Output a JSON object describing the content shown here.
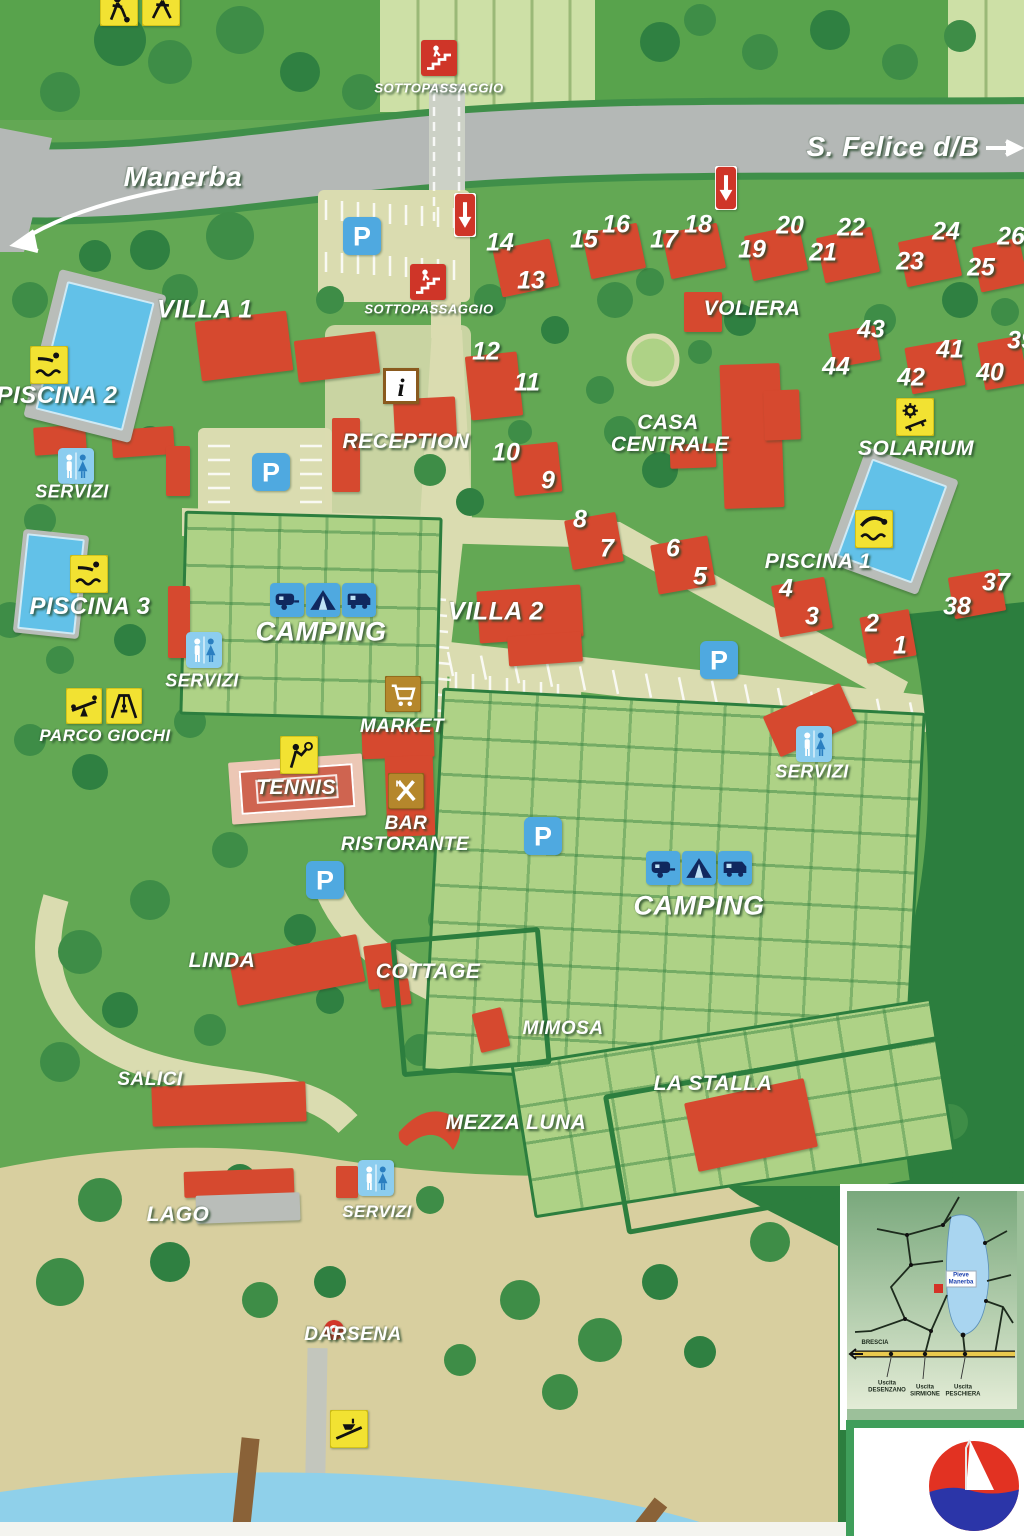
{
  "map": {
    "road_labels": [
      {
        "text": "Manerba",
        "x": 183,
        "y": 177,
        "size": 28
      },
      {
        "text": "S. Felice d/B",
        "x": 893,
        "y": 147,
        "size": 28
      }
    ],
    "place_labels": [
      {
        "text": "SOTTOPASSAGGIO",
        "x": 439,
        "y": 88,
        "size": 13
      },
      {
        "text": "SOTTOPASSAGGIO",
        "x": 429,
        "y": 309,
        "size": 13
      },
      {
        "text": "VILLA 1",
        "x": 205,
        "y": 310,
        "size": 25
      },
      {
        "text": "PISCINA 2",
        "x": 57,
        "y": 396,
        "size": 24
      },
      {
        "text": "SERVIZI",
        "x": 72,
        "y": 492,
        "size": 18
      },
      {
        "text": "PISCINA 3",
        "x": 90,
        "y": 607,
        "size": 24
      },
      {
        "text": "RECEPTION",
        "x": 406,
        "y": 442,
        "size": 21
      },
      {
        "text": "CASA",
        "x": 668,
        "y": 423,
        "size": 21
      },
      {
        "text": "CENTRALE",
        "x": 670,
        "y": 445,
        "size": 21
      },
      {
        "text": "VOLIERA",
        "x": 752,
        "y": 309,
        "size": 21
      },
      {
        "text": "SOLARIUM",
        "x": 916,
        "y": 449,
        "size": 21
      },
      {
        "text": "PISCINA 1",
        "x": 818,
        "y": 562,
        "size": 21
      },
      {
        "text": "CAMPING",
        "x": 321,
        "y": 632,
        "size": 27
      },
      {
        "text": "VILLA 2",
        "x": 496,
        "y": 612,
        "size": 25
      },
      {
        "text": "SERVIZI",
        "x": 202,
        "y": 681,
        "size": 18
      },
      {
        "text": "PARCO GIOCHI",
        "x": 105,
        "y": 736,
        "size": 17
      },
      {
        "text": "MARKET",
        "x": 402,
        "y": 727,
        "size": 19
      },
      {
        "text": "TENNIS",
        "x": 296,
        "y": 788,
        "size": 21
      },
      {
        "text": "BAR",
        "x": 406,
        "y": 824,
        "size": 19
      },
      {
        "text": "RISTORANTE",
        "x": 405,
        "y": 845,
        "size": 19
      },
      {
        "text": "SERVIZI",
        "x": 812,
        "y": 772,
        "size": 18
      },
      {
        "text": "CAMPING",
        "x": 699,
        "y": 906,
        "size": 27
      },
      {
        "text": "LINDA",
        "x": 222,
        "y": 961,
        "size": 21
      },
      {
        "text": "COTTAGE",
        "x": 428,
        "y": 972,
        "size": 21
      },
      {
        "text": "MIMOSA",
        "x": 563,
        "y": 1029,
        "size": 19
      },
      {
        "text": "SALICI",
        "x": 150,
        "y": 1080,
        "size": 19
      },
      {
        "text": "LA STALLA",
        "x": 713,
        "y": 1084,
        "size": 21
      },
      {
        "text": "MEZZA LUNA",
        "x": 516,
        "y": 1123,
        "size": 21
      },
      {
        "text": "LAGO",
        "x": 178,
        "y": 1215,
        "size": 21
      },
      {
        "text": "SERVIZI",
        "x": 377,
        "y": 1212,
        "size": 17
      },
      {
        "text": "DARSENA",
        "x": 353,
        "y": 1335,
        "size": 19
      }
    ],
    "numbers": [
      {
        "n": "1",
        "x": 900,
        "y": 646
      },
      {
        "n": "2",
        "x": 872,
        "y": 624
      },
      {
        "n": "3",
        "x": 812,
        "y": 617
      },
      {
        "n": "4",
        "x": 786,
        "y": 589
      },
      {
        "n": "5",
        "x": 700,
        "y": 577
      },
      {
        "n": "6",
        "x": 673,
        "y": 549
      },
      {
        "n": "7",
        "x": 607,
        "y": 549
      },
      {
        "n": "8",
        "x": 580,
        "y": 520
      },
      {
        "n": "9",
        "x": 548,
        "y": 481
      },
      {
        "n": "10",
        "x": 506,
        "y": 453
      },
      {
        "n": "11",
        "x": 527,
        "y": 383
      },
      {
        "n": "12",
        "x": 486,
        "y": 352
      },
      {
        "n": "13",
        "x": 531,
        "y": 281
      },
      {
        "n": "14",
        "x": 500,
        "y": 243
      },
      {
        "n": "15",
        "x": 584,
        "y": 240
      },
      {
        "n": "16",
        "x": 616,
        "y": 225
      },
      {
        "n": "17",
        "x": 664,
        "y": 240
      },
      {
        "n": "18",
        "x": 698,
        "y": 225
      },
      {
        "n": "19",
        "x": 752,
        "y": 250
      },
      {
        "n": "20",
        "x": 790,
        "y": 226
      },
      {
        "n": "21",
        "x": 823,
        "y": 253
      },
      {
        "n": "22",
        "x": 851,
        "y": 228
      },
      {
        "n": "23",
        "x": 910,
        "y": 262
      },
      {
        "n": "24",
        "x": 946,
        "y": 232
      },
      {
        "n": "25",
        "x": 981,
        "y": 268
      },
      {
        "n": "26",
        "x": 1011,
        "y": 237
      },
      {
        "n": "37",
        "x": 996,
        "y": 583
      },
      {
        "n": "38",
        "x": 957,
        "y": 607
      },
      {
        "n": "39",
        "x": 1021,
        "y": 341
      },
      {
        "n": "40",
        "x": 990,
        "y": 373
      },
      {
        "n": "41",
        "x": 950,
        "y": 350
      },
      {
        "n": "42",
        "x": 911,
        "y": 378
      },
      {
        "n": "43",
        "x": 871,
        "y": 330
      },
      {
        "n": "44",
        "x": 836,
        "y": 367
      }
    ],
    "icons": [
      {
        "type": "soccer",
        "x": 100,
        "y": -12,
        "w": 38,
        "h": 38
      },
      {
        "type": "runner",
        "x": 142,
        "y": -12,
        "w": 38,
        "h": 38
      },
      {
        "type": "underpass",
        "x": 421,
        "y": 40,
        "w": 36,
        "h": 36
      },
      {
        "type": "underpass",
        "x": 410,
        "y": 264,
        "w": 36,
        "h": 36
      },
      {
        "type": "oneway",
        "x": 454,
        "y": 193,
        "w": 22,
        "h": 44
      },
      {
        "type": "oneway",
        "x": 715,
        "y": 166,
        "w": 22,
        "h": 44
      },
      {
        "type": "parking",
        "x": 343,
        "y": 214,
        "w": 38,
        "h": 44
      },
      {
        "type": "parking",
        "x": 252,
        "y": 450,
        "w": 38,
        "h": 44
      },
      {
        "type": "parking",
        "x": 700,
        "y": 638,
        "w": 38,
        "h": 44
      },
      {
        "type": "parking",
        "x": 524,
        "y": 814,
        "w": 38,
        "h": 44
      },
      {
        "type": "parking",
        "x": 306,
        "y": 858,
        "w": 38,
        "h": 44
      },
      {
        "type": "waterslide",
        "x": 30,
        "y": 346,
        "w": 38,
        "h": 38
      },
      {
        "type": "waterslide",
        "x": 70,
        "y": 555,
        "w": 38,
        "h": 38
      },
      {
        "type": "diving",
        "x": 855,
        "y": 510,
        "w": 38,
        "h": 38
      },
      {
        "type": "solarium",
        "x": 896,
        "y": 398,
        "w": 38,
        "h": 38
      },
      {
        "type": "info",
        "x": 383,
        "y": 368,
        "w": 36,
        "h": 36
      },
      {
        "type": "toilet",
        "x": 58,
        "y": 448,
        "w": 36,
        "h": 36
      },
      {
        "type": "toilet",
        "x": 186,
        "y": 632,
        "w": 36,
        "h": 36
      },
      {
        "type": "toilet",
        "x": 796,
        "y": 726,
        "w": 36,
        "h": 36
      },
      {
        "type": "toilet",
        "x": 358,
        "y": 1160,
        "w": 36,
        "h": 36
      },
      {
        "type": "seesaw",
        "x": 66,
        "y": 688,
        "w": 36,
        "h": 36
      },
      {
        "type": "swing",
        "x": 106,
        "y": 688,
        "w": 36,
        "h": 36
      },
      {
        "type": "market",
        "x": 385,
        "y": 676,
        "w": 36,
        "h": 36
      },
      {
        "type": "tennis",
        "x": 280,
        "y": 736,
        "w": 38,
        "h": 38
      },
      {
        "type": "bar",
        "x": 388,
        "y": 773,
        "w": 36,
        "h": 36
      },
      {
        "type": "caravan",
        "x": 270,
        "y": 583,
        "w": 34,
        "h": 34
      },
      {
        "type": "tent",
        "x": 306,
        "y": 583,
        "w": 34,
        "h": 34
      },
      {
        "type": "camper",
        "x": 342,
        "y": 583,
        "w": 34,
        "h": 34
      },
      {
        "type": "caravan",
        "x": 646,
        "y": 851,
        "w": 34,
        "h": 34
      },
      {
        "type": "tent",
        "x": 682,
        "y": 851,
        "w": 34,
        "h": 34
      },
      {
        "type": "camper",
        "x": 718,
        "y": 851,
        "w": 34,
        "h": 34
      },
      {
        "type": "boat",
        "x": 330,
        "y": 1410,
        "w": 38,
        "h": 38
      },
      {
        "type": "lifebuoy",
        "x": 322,
        "y": 1318,
        "w": 24,
        "h": 24
      }
    ],
    "buildings": [
      {
        "name": "villa1-a",
        "x": 198,
        "y": 316,
        "w": 92,
        "h": 60,
        "r": -7
      },
      {
        "name": "villa1-b",
        "x": 296,
        "y": 336,
        "w": 82,
        "h": 42,
        "r": -7
      },
      {
        "name": "piscina2-bldg-a",
        "x": 34,
        "y": 426,
        "w": 52,
        "h": 28,
        "r": -4
      },
      {
        "name": "piscina2-bldg-b",
        "x": 112,
        "y": 428,
        "w": 62,
        "h": 28,
        "r": -4
      },
      {
        "name": "small-red",
        "x": 166,
        "y": 446,
        "w": 24,
        "h": 50,
        "r": 0
      },
      {
        "name": "reception-a",
        "x": 332,
        "y": 418,
        "w": 28,
        "h": 74,
        "r": 0
      },
      {
        "name": "reception-b",
        "x": 394,
        "y": 398,
        "w": 62,
        "h": 40,
        "r": -3
      },
      {
        "name": "voliera-bldg",
        "x": 684,
        "y": 292,
        "w": 38,
        "h": 40,
        "r": 0
      },
      {
        "name": "casa-centrale-a",
        "x": 722,
        "y": 364,
        "w": 60,
        "h": 144,
        "r": -2
      },
      {
        "name": "casa-centrale-b",
        "x": 764,
        "y": 390,
        "w": 36,
        "h": 50,
        "r": -2
      },
      {
        "name": "casa-small",
        "x": 670,
        "y": 444,
        "w": 46,
        "h": 24,
        "r": -2
      },
      {
        "name": "camp-left-red",
        "x": 168,
        "y": 586,
        "w": 22,
        "h": 72,
        "r": 0
      },
      {
        "name": "villa2-a",
        "x": 478,
        "y": 588,
        "w": 104,
        "h": 52,
        "r": -4
      },
      {
        "name": "villa2-b",
        "x": 508,
        "y": 634,
        "w": 74,
        "h": 30,
        "r": -4
      },
      {
        "name": "market-bar-a",
        "x": 362,
        "y": 728,
        "w": 72,
        "h": 30,
        "r": -2
      },
      {
        "name": "market-bar-b",
        "x": 386,
        "y": 756,
        "w": 48,
        "h": 80,
        "r": -2
      },
      {
        "name": "servizi-right-bldg",
        "x": 768,
        "y": 698,
        "w": 84,
        "h": 44,
        "r": -24
      },
      {
        "name": "linda-bldg",
        "x": 232,
        "y": 946,
        "w": 130,
        "h": 48,
        "r": -11
      },
      {
        "name": "cottage-a",
        "x": 366,
        "y": 944,
        "w": 32,
        "h": 44,
        "r": -8
      },
      {
        "name": "cottage-b",
        "x": 380,
        "y": 980,
        "w": 30,
        "h": 26,
        "r": -8
      },
      {
        "name": "salici-bldg",
        "x": 152,
        "y": 1084,
        "w": 154,
        "h": 40,
        "r": -2
      },
      {
        "name": "mimosa-bldg",
        "x": 476,
        "y": 1010,
        "w": 30,
        "h": 40,
        "r": -14
      },
      {
        "name": "lastalla-bldg",
        "x": 690,
        "y": 1090,
        "w": 122,
        "h": 70,
        "r": -12
      },
      {
        "name": "lago-roof",
        "x": 184,
        "y": 1170,
        "w": 110,
        "h": 26,
        "r": -2
      },
      {
        "name": "lago-body",
        "x": 196,
        "y": 1194,
        "w": 104,
        "h": 28,
        "r": -2,
        "color": "#b9bdb9"
      },
      {
        "name": "servizi-bottom-bldg",
        "x": 336,
        "y": 1166,
        "w": 22,
        "h": 32,
        "r": 0
      },
      {
        "name": "bungalow-13-14",
        "x": 497,
        "y": 244,
        "w": 58,
        "h": 48,
        "r": -12
      },
      {
        "name": "bungalow-15-16",
        "x": 586,
        "y": 228,
        "w": 56,
        "h": 46,
        "r": -12
      },
      {
        "name": "bungalow-17-18",
        "x": 666,
        "y": 228,
        "w": 56,
        "h": 46,
        "r": -12
      },
      {
        "name": "bungalow-19-20",
        "x": 748,
        "y": 230,
        "w": 56,
        "h": 46,
        "r": -12
      },
      {
        "name": "bungalow-21-22",
        "x": 820,
        "y": 232,
        "w": 56,
        "h": 46,
        "r": -12
      },
      {
        "name": "bungalow-23-24",
        "x": 902,
        "y": 236,
        "w": 56,
        "h": 46,
        "r": -12
      },
      {
        "name": "bungalow-25-26",
        "x": 976,
        "y": 242,
        "w": 48,
        "h": 46,
        "r": -12
      },
      {
        "name": "bungalow-11-12",
        "x": 468,
        "y": 354,
        "w": 52,
        "h": 64,
        "r": -6
      },
      {
        "name": "bungalow-9-10",
        "x": 512,
        "y": 444,
        "w": 48,
        "h": 50,
        "r": -6
      },
      {
        "name": "bungalow-7-8",
        "x": 568,
        "y": 516,
        "w": 52,
        "h": 50,
        "r": -10
      },
      {
        "name": "bungalow-5-6",
        "x": 654,
        "y": 540,
        "w": 58,
        "h": 50,
        "r": -10
      },
      {
        "name": "bungalow-3-4",
        "x": 775,
        "y": 581,
        "w": 54,
        "h": 52,
        "r": -10
      },
      {
        "name": "bungalow-1-2",
        "x": 863,
        "y": 613,
        "w": 50,
        "h": 47,
        "r": -10
      },
      {
        "name": "bungalow-37-38",
        "x": 951,
        "y": 573,
        "w": 52,
        "h": 42,
        "r": -10
      },
      {
        "name": "bungalow-43-44",
        "x": 831,
        "y": 329,
        "w": 47,
        "h": 35,
        "r": -10
      },
      {
        "name": "bungalow-41-42",
        "x": 908,
        "y": 343,
        "w": 54,
        "h": 47,
        "r": -10
      },
      {
        "name": "bungalow-39-40",
        "x": 981,
        "y": 339,
        "w": 43,
        "h": 48,
        "r": -10
      },
      {
        "name": "tennis-court-area",
        "x": 230,
        "y": 758,
        "w": 134,
        "h": 62,
        "r": -4,
        "kind": "tennis",
        "color": "#ecc7b5"
      },
      {
        "name": "mezza-luna-bldg",
        "x": 393,
        "y": 1092,
        "w": 74,
        "h": 74,
        "r": 0,
        "kind": "crescent"
      },
      {
        "name": "lastalla-plot-outline",
        "x": 612,
        "y": 1058,
        "w": 404,
        "h": 132,
        "r": -10,
        "kind": "outline"
      },
      {
        "name": "cottage-plot-outline",
        "x": 396,
        "y": 933,
        "w": 140,
        "h": 128,
        "r": -5,
        "kind": "outline"
      }
    ],
    "pools": [
      {
        "name": "piscina-2-pool",
        "x": 40,
        "y": 280,
        "w": 110,
        "h": 152,
        "r": 14,
        "pad": 10
      },
      {
        "name": "piscina-1-pool",
        "x": 843,
        "y": 460,
        "w": 98,
        "h": 122,
        "r": 20,
        "pad": 9
      },
      {
        "name": "piscina-3-pool",
        "x": 18,
        "y": 532,
        "w": 66,
        "h": 104,
        "r": 6,
        "pad": 4
      }
    ],
    "inset": {
      "marker_label": "Pieve\nManerba",
      "labels": [
        {
          "text": "BRESCIA",
          "x": 28,
          "y": 152
        },
        {
          "text": "Uscita\nDESENZANO",
          "x": 40,
          "y": 196
        },
        {
          "text": "Uscita\nSIRMIONE",
          "x": 78,
          "y": 200
        },
        {
          "text": "Uscita\nPESCHIERA",
          "x": 116,
          "y": 200
        }
      ]
    },
    "colors": {
      "building_red": "#d6492f",
      "pool_blue": "#62c1e8",
      "road_gray": "#b4b8b6",
      "base_green": "#63a854",
      "forest_green": "#2c7e3e",
      "plot_green": "#aed286",
      "path_beige": "#dadcb0",
      "sign_yellow": "#f2e232",
      "sign_red": "#cf3528",
      "sign_blue": "#4fa9e0",
      "logo_red": "#e23222",
      "logo_navy": "#2b35a8"
    }
  }
}
